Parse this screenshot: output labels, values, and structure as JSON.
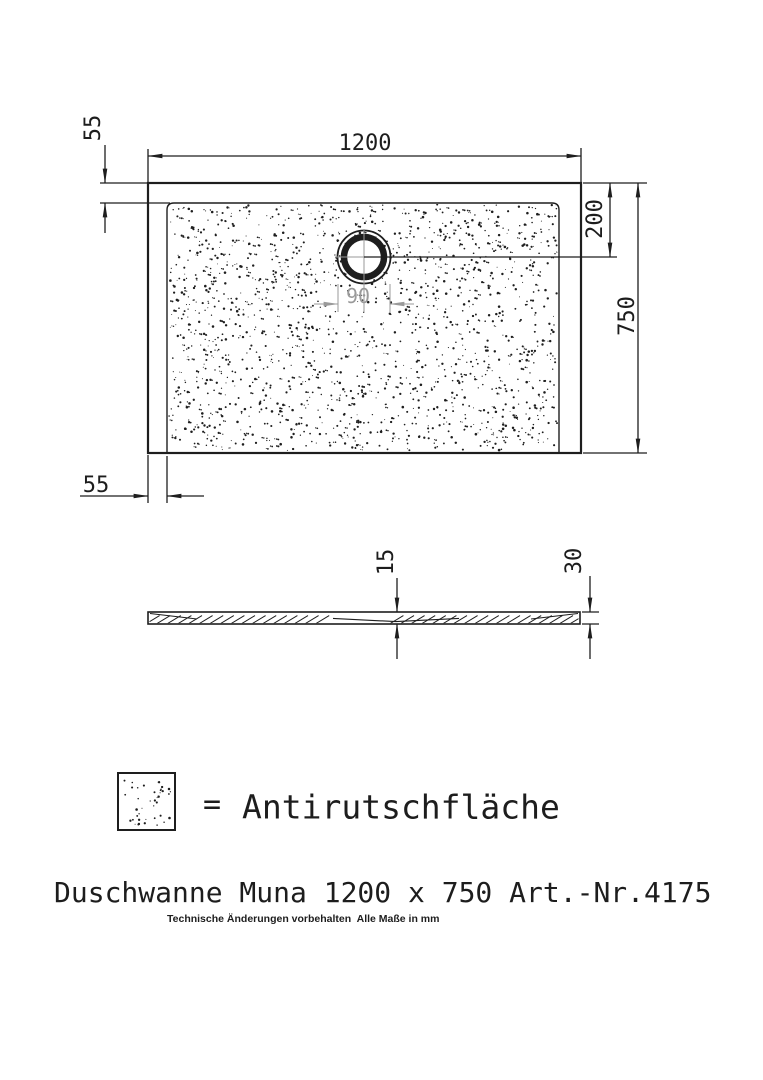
{
  "top_view": {
    "width_label": "1200",
    "top_inset_label": "55",
    "left_inset_label": "55",
    "drain_offset_label": "200",
    "depth_label": "750",
    "drain_diameter_label": "90"
  },
  "side_view": {
    "center_thickness_label": "15",
    "edge_thickness_label": "30"
  },
  "legend": {
    "equals_sign": "=",
    "label": "Antirutschfläche"
  },
  "footer": {
    "title": "Duschwanne Muna 1200 x 750 Art.-Nr.4175",
    "note": "Technische Änderungen vorbehalten  Alle Maße in mm"
  },
  "colors": {
    "line": "#1e1e1e",
    "dim_gray": "#9a9a9a",
    "background": "#ffffff"
  }
}
